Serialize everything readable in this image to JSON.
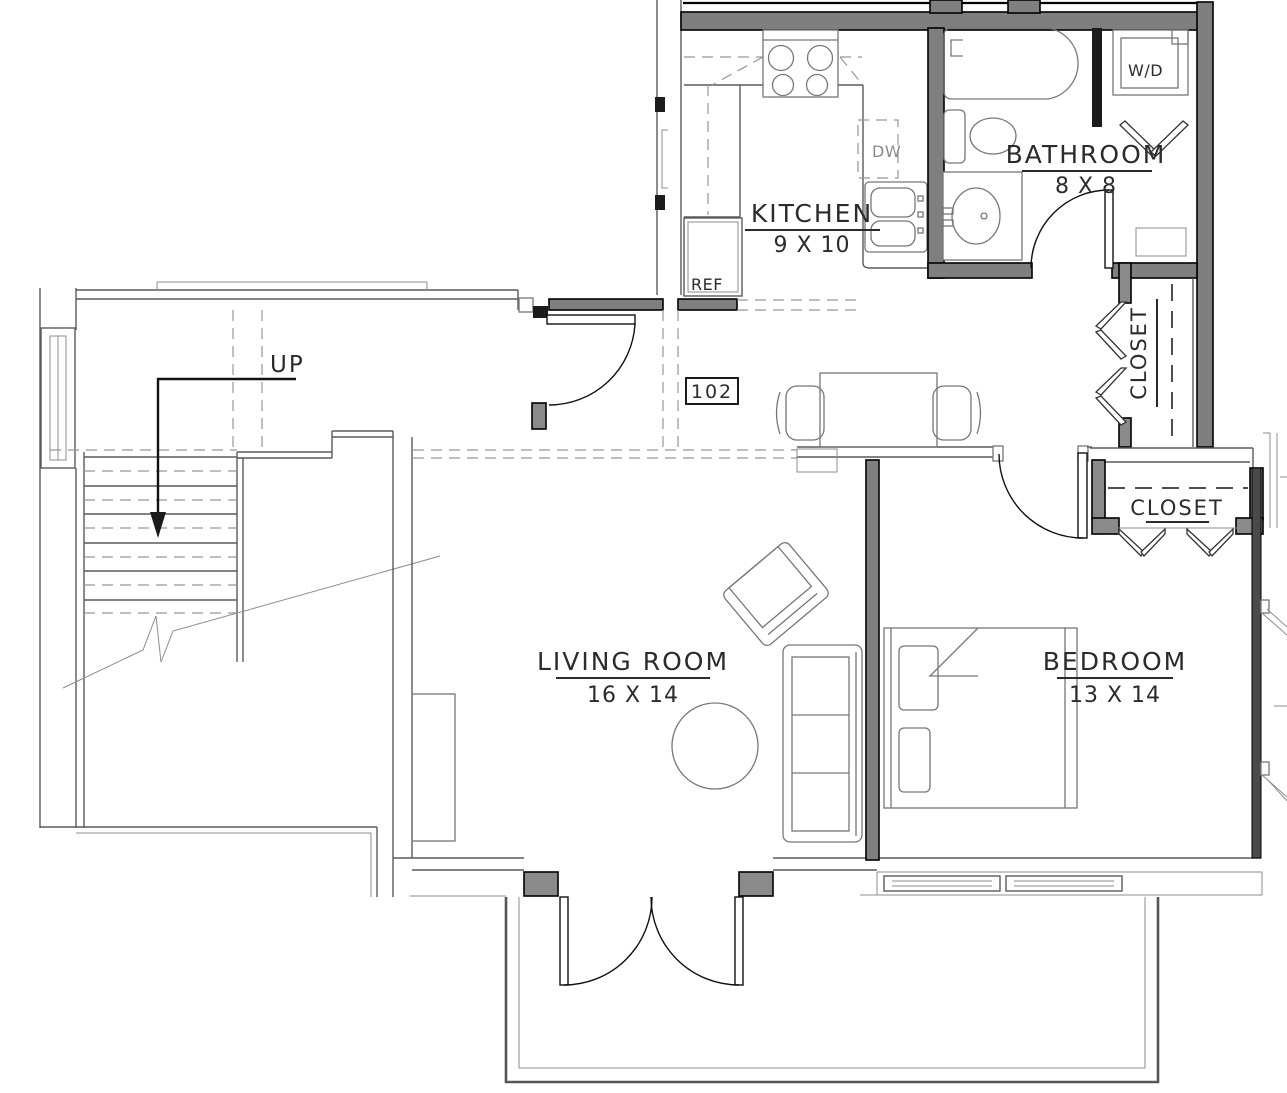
{
  "plan": {
    "unit_number": "102",
    "rooms": [
      {
        "id": "kitchen",
        "label": "KITCHEN",
        "dims": "9 X 10"
      },
      {
        "id": "bathroom",
        "label": "BATHROOM",
        "dims": "8 X 8"
      },
      {
        "id": "living-room",
        "label": "LIVING ROOM",
        "dims": "16 X 14"
      },
      {
        "id": "bedroom",
        "label": "BEDROOM",
        "dims": "13 X 14"
      },
      {
        "id": "hall-closet",
        "label": "CLOSET"
      },
      {
        "id": "bedroom-closet",
        "label": "CLOSET"
      }
    ],
    "fixtures": {
      "refrigerator": "REF",
      "dishwasher": "DW",
      "washer_dryer": "W/D"
    },
    "stairs": {
      "direction_label": "UP"
    }
  },
  "colors": {
    "wall_fill": "#7f7f7f",
    "wall_edge": "#000000",
    "thin_line": "#5a5a5a",
    "furniture_line": "#777777",
    "dashed_line": "#979797",
    "text": "#2b2b2b",
    "background": "#ffffff"
  }
}
